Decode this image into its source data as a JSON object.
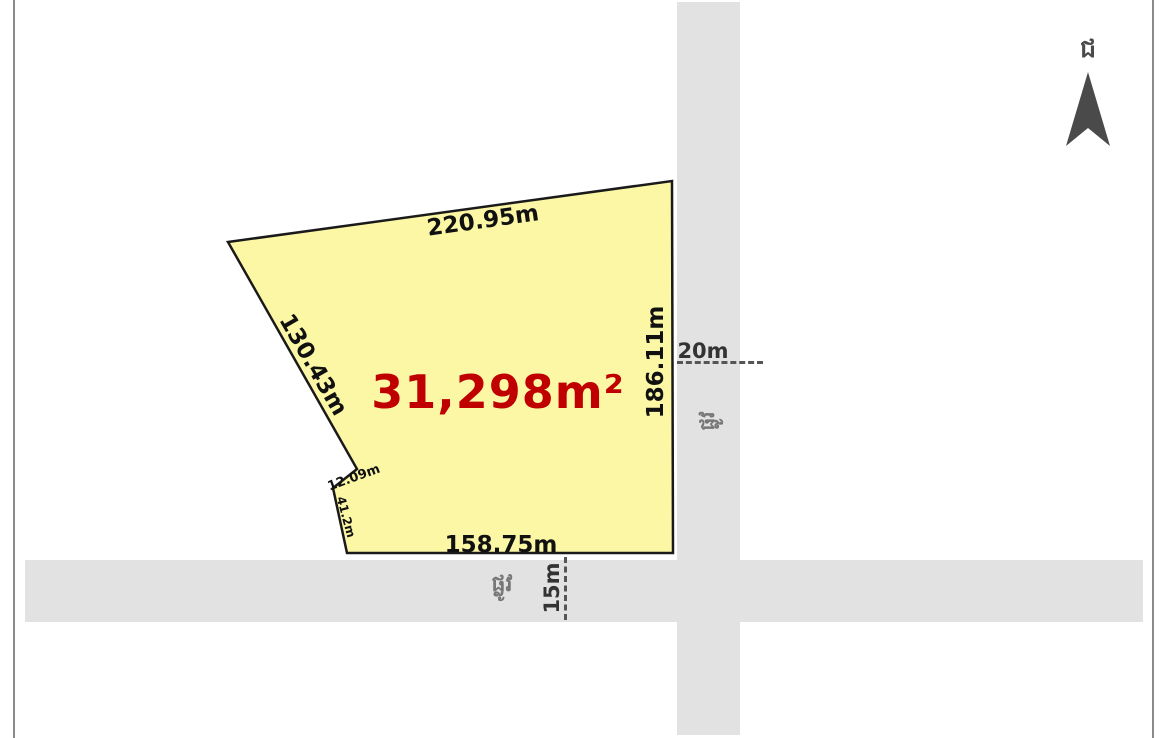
{
  "parcel": {
    "area_label": "31,298m²",
    "edge_labels": {
      "top": "220.95m",
      "left": "130.43m",
      "right": "186.11m",
      "bottom": "158.75m",
      "notch_upper": "12.09m",
      "notch_lower": "41.2m"
    },
    "fill_color": "#fbf7a5",
    "outline_color": "#1a1a1a",
    "area_text_color": "#c00000"
  },
  "roads": {
    "fill_color": "#e2e2e2",
    "vertical": {
      "name_label": "ផ្លូវ",
      "width_label": "20m"
    },
    "horizontal": {
      "name_label": "ផ្លូវ",
      "width_label": "15m"
    }
  },
  "compass": {
    "north_label": "ជ"
  }
}
